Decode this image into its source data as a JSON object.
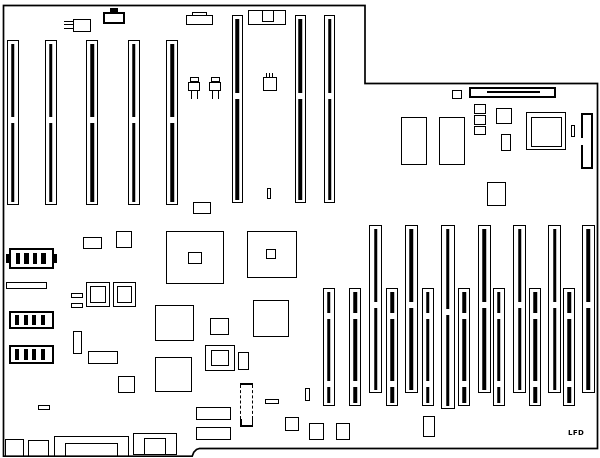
{
  "diagram": {
    "title": "motherboard-layout-diagram",
    "label": {
      "text": "LFD",
      "x": 568,
      "y": 429
    },
    "colors": {
      "line": "#000000",
      "background": "#ffffff"
    },
    "board_path": "M3.5 5.5 H365 V83.5 H597.5 V448.5 H199.5 L196.5 449.5 L193.8 452.2 L192.2 456.2 H3.5 Z",
    "primitives": [
      {
        "n": "isa-slot-1",
        "k": "s",
        "x": 6.5,
        "y": 40,
        "w": 12,
        "h": 165,
        "g": [
          0.46
        ]
      },
      {
        "n": "isa-slot-2",
        "k": "s",
        "x": 44.5,
        "y": 40,
        "w": 12,
        "h": 165,
        "g": [
          0.46
        ]
      },
      {
        "n": "isa-slot-3",
        "k": "s",
        "x": 86,
        "y": 40,
        "w": 12,
        "h": 165,
        "g": [
          0.46
        ]
      },
      {
        "n": "isa-slot-4",
        "k": "s",
        "x": 127.5,
        "y": 40,
        "w": 12,
        "h": 165,
        "g": [
          0.46
        ]
      },
      {
        "n": "isa-slot-5",
        "k": "s",
        "x": 166,
        "y": 40,
        "w": 12,
        "h": 165,
        "g": [
          0.46
        ]
      },
      {
        "n": "isa-slot-6",
        "k": "s",
        "x": 231.5,
        "y": 15,
        "w": 11,
        "h": 188,
        "g": [
          0.41
        ]
      },
      {
        "n": "isa-slot-7",
        "k": "s",
        "x": 294.5,
        "y": 15,
        "w": 11,
        "h": 188,
        "g": [
          0.41
        ]
      },
      {
        "n": "isa-slot-8",
        "k": "s",
        "x": 324,
        "y": 15,
        "w": 11,
        "h": 188,
        "g": [
          0.41
        ]
      },
      {
        "n": "mem-slot-1",
        "k": "s",
        "x": 322.5,
        "y": 288,
        "w": 12,
        "h": 118,
        "g": [
          0.2,
          0.78
        ]
      },
      {
        "n": "mem-slot-2",
        "k": "s",
        "x": 349,
        "y": 288,
        "w": 12,
        "h": 118,
        "g": [
          0.2,
          0.78
        ]
      },
      {
        "n": "mem-slot-3",
        "k": "s",
        "x": 369,
        "y": 225,
        "w": 13,
        "h": 168,
        "g": [
          0.45
        ]
      },
      {
        "n": "mem-slot-4",
        "k": "s",
        "x": 386,
        "y": 288,
        "w": 12,
        "h": 118,
        "g": [
          0.2,
          0.78
        ]
      },
      {
        "n": "mem-slot-5",
        "k": "s",
        "x": 404.5,
        "y": 225,
        "w": 13,
        "h": 168,
        "g": [
          0.45
        ]
      },
      {
        "n": "mem-slot-6",
        "k": "s",
        "x": 421.5,
        "y": 288,
        "w": 12,
        "h": 118,
        "g": [
          0.2,
          0.78
        ]
      },
      {
        "n": "mem-slot-7",
        "k": "s",
        "x": 441,
        "y": 225,
        "w": 13.5,
        "h": 184,
        "g": [
          0.45
        ]
      },
      {
        "n": "mem-slot-8",
        "k": "s",
        "x": 458,
        "y": 288,
        "w": 12,
        "h": 118,
        "g": [
          0.2,
          0.78
        ]
      },
      {
        "n": "mem-slot-9",
        "k": "s",
        "x": 477.5,
        "y": 225,
        "w": 13,
        "h": 168,
        "g": [
          0.45
        ]
      },
      {
        "n": "mem-slot-10",
        "k": "s",
        "x": 492.5,
        "y": 288,
        "w": 12,
        "h": 118,
        "g": [
          0.2,
          0.78
        ]
      },
      {
        "n": "mem-slot-11",
        "k": "s",
        "x": 513,
        "y": 225,
        "w": 13,
        "h": 168,
        "g": [
          0.45
        ]
      },
      {
        "n": "mem-slot-12",
        "k": "s",
        "x": 529,
        "y": 288,
        "w": 12,
        "h": 118,
        "g": [
          0.2,
          0.78
        ]
      },
      {
        "n": "mem-slot-13",
        "k": "s",
        "x": 548,
        "y": 225,
        "w": 13,
        "h": 168,
        "g": [
          0.45
        ]
      },
      {
        "n": "mem-slot-14",
        "k": "s",
        "x": 563,
        "y": 288,
        "w": 12,
        "h": 118,
        "g": [
          0.2,
          0.78
        ]
      },
      {
        "n": "mem-slot-15",
        "k": "s",
        "x": 581.5,
        "y": 225,
        "w": 13,
        "h": 168,
        "g": [
          0.45
        ]
      },
      {
        "n": "crystal-body",
        "k": "r",
        "x": 72.5,
        "y": 18.5,
        "w": 18.5,
        "h": 13
      },
      {
        "n": "crystal-pin-1",
        "k": "f",
        "x": 63.5,
        "y": 20.8,
        "w": 9.5,
        "h": 1.3
      },
      {
        "n": "crystal-pin-2",
        "k": "f",
        "x": 63.5,
        "y": 24.2,
        "w": 9.5,
        "h": 1.3
      },
      {
        "n": "crystal-pin-3",
        "k": "f",
        "x": 63.5,
        "y": 27.6,
        "w": 9.5,
        "h": 1.3
      },
      {
        "n": "top-connector-tab",
        "k": "f",
        "x": 110,
        "y": 8,
        "w": 7.5,
        "h": 4.5
      },
      {
        "n": "top-connector-body",
        "k": "t",
        "x": 103,
        "y": 11.5,
        "w": 22,
        "h": 12
      },
      {
        "n": "kbd-connector-step",
        "k": "r",
        "x": 191.5,
        "y": 12,
        "w": 15,
        "h": 3.5
      },
      {
        "n": "kbd-connector-body",
        "k": "r",
        "x": 186,
        "y": 15,
        "w": 26.5,
        "h": 10
      },
      {
        "n": "din-connector-body",
        "k": "r",
        "x": 248,
        "y": 10,
        "w": 38,
        "h": 15
      },
      {
        "n": "din-connector-notch",
        "k": "r",
        "x": 262,
        "y": 10,
        "w": 12,
        "h": 11.5
      },
      {
        "n": "transistor-1-tab",
        "k": "r",
        "x": 190,
        "y": 76.5,
        "w": 8.5,
        "h": 5.5
      },
      {
        "n": "transistor-1-body",
        "k": "r",
        "x": 188,
        "y": 81.5,
        "w": 12,
        "h": 9.5
      },
      {
        "n": "transistor-1-leg-1",
        "k": "f",
        "x": 191,
        "y": 91,
        "w": 1.4,
        "h": 7.5
      },
      {
        "n": "transistor-1-leg-2",
        "k": "f",
        "x": 196.5,
        "y": 91,
        "w": 1.4,
        "h": 7.5
      },
      {
        "n": "transistor-2-tab",
        "k": "r",
        "x": 211,
        "y": 76.5,
        "w": 8.5,
        "h": 5.5
      },
      {
        "n": "transistor-2-body",
        "k": "r",
        "x": 209,
        "y": 81.5,
        "w": 12,
        "h": 9.5
      },
      {
        "n": "transistor-2-leg-1",
        "k": "f",
        "x": 212,
        "y": 91,
        "w": 1.4,
        "h": 7.5
      },
      {
        "n": "transistor-2-leg-2",
        "k": "f",
        "x": 217.5,
        "y": 91,
        "w": 1.4,
        "h": 7.5
      },
      {
        "n": "cap-pin-1",
        "k": "f",
        "x": 265.5,
        "y": 72.5,
        "w": 1.3,
        "h": 5
      },
      {
        "n": "cap-pin-2",
        "k": "f",
        "x": 268.5,
        "y": 72.5,
        "w": 1.3,
        "h": 5
      },
      {
        "n": "cap-pin-3",
        "k": "f",
        "x": 271.5,
        "y": 72.5,
        "w": 1.3,
        "h": 5
      },
      {
        "n": "cap-body",
        "k": "r",
        "x": 263,
        "y": 77,
        "w": 14,
        "h": 14
      },
      {
        "n": "mid-tiny-vrect",
        "k": "r",
        "x": 267,
        "y": 188,
        "w": 4,
        "h": 10.5
      },
      {
        "n": "ne-small-rect",
        "k": "r",
        "x": 451.5,
        "y": 89.5,
        "w": 10.5,
        "h": 9
      },
      {
        "n": "ne-long-connector",
        "k": "t",
        "x": 469,
        "y": 86.5,
        "w": 87,
        "h": 11.5
      },
      {
        "n": "ne-long-connector-key",
        "k": "f",
        "x": 487,
        "y": 90.8,
        "w": 53,
        "h": 1.8
      },
      {
        "n": "ram-chip-1",
        "k": "r",
        "x": 400.5,
        "y": 116.5,
        "w": 26,
        "h": 48.5
      },
      {
        "n": "ram-chip-2",
        "k": "r",
        "x": 438.5,
        "y": 116.5,
        "w": 26,
        "h": 48.5
      },
      {
        "n": "sq-stack-1",
        "k": "r",
        "x": 474,
        "y": 104,
        "w": 11.5,
        "h": 9.5
      },
      {
        "n": "sq-stack-2",
        "k": "r",
        "x": 474,
        "y": 115,
        "w": 11.5,
        "h": 9.5
      },
      {
        "n": "sq-stack-3",
        "k": "r",
        "x": 474,
        "y": 126,
        "w": 11.5,
        "h": 8.5
      },
      {
        "n": "ne-med-square",
        "k": "r",
        "x": 496,
        "y": 107.5,
        "w": 16,
        "h": 16
      },
      {
        "n": "ne-small-vrect",
        "k": "r",
        "x": 501,
        "y": 134,
        "w": 10,
        "h": 16.5
      },
      {
        "n": "cpu-outer",
        "k": "r",
        "x": 526,
        "y": 112,
        "w": 40,
        "h": 38
      },
      {
        "n": "cpu-inner",
        "k": "r",
        "x": 530.5,
        "y": 116.5,
        "w": 31.5,
        "h": 30
      },
      {
        "n": "cpu-side-rect",
        "k": "r",
        "x": 570.5,
        "y": 124.5,
        "w": 4.5,
        "h": 12.5
      },
      {
        "n": "right-edge-connector",
        "k": "t",
        "x": 580.5,
        "y": 112.5,
        "w": 12,
        "h": 56
      },
      {
        "n": "right-edge-connector-gap",
        "k": "w",
        "x": 578.5,
        "y": 138,
        "w": 5,
        "h": 6.5
      },
      {
        "n": "ne-square-low",
        "k": "r",
        "x": 486.5,
        "y": 182,
        "w": 19.5,
        "h": 24
      },
      {
        "n": "chip-1-outer",
        "k": "r",
        "x": 166,
        "y": 231,
        "w": 58,
        "h": 53
      },
      {
        "n": "chip-1-inner",
        "k": "r",
        "x": 188,
        "y": 251.5,
        "w": 13.5,
        "h": 12
      },
      {
        "n": "chip-2-outer",
        "k": "r",
        "x": 247,
        "y": 231,
        "w": 50,
        "h": 47
      },
      {
        "n": "chip-2-inner",
        "k": "r",
        "x": 266,
        "y": 249,
        "w": 10,
        "h": 10
      },
      {
        "n": "mid-small-rect",
        "k": "r",
        "x": 193,
        "y": 201.5,
        "w": 17.5,
        "h": 12
      },
      {
        "n": "left-small-rect",
        "k": "r",
        "x": 83,
        "y": 237,
        "w": 18.5,
        "h": 12
      },
      {
        "n": "left-small-square",
        "k": "r",
        "x": 116,
        "y": 231,
        "w": 16,
        "h": 16.5
      },
      {
        "n": "battery",
        "k": "t",
        "x": 9,
        "y": 248,
        "w": 44.5,
        "h": 20.5
      },
      {
        "n": "battery-cell-1",
        "k": "f",
        "x": 15.5,
        "y": 252.5,
        "w": 4.5,
        "h": 11.5
      },
      {
        "n": "battery-cell-2",
        "k": "f",
        "x": 24,
        "y": 252.5,
        "w": 4.5,
        "h": 11.5
      },
      {
        "n": "battery-cell-3",
        "k": "f",
        "x": 32.5,
        "y": 252.5,
        "w": 4.5,
        "h": 11.5
      },
      {
        "n": "battery-cell-4",
        "k": "f",
        "x": 41,
        "y": 252.5,
        "w": 4.5,
        "h": 11.5
      },
      {
        "n": "battery-tab-left",
        "k": "f",
        "x": 5.5,
        "y": 253.5,
        "w": 3.5,
        "h": 9.5
      },
      {
        "n": "battery-tab-right",
        "k": "f",
        "x": 53.5,
        "y": 253.5,
        "w": 3.5,
        "h": 9.5
      },
      {
        "n": "jumper-block-1",
        "k": "t",
        "x": 9,
        "y": 310.5,
        "w": 44.5,
        "h": 18.5
      },
      {
        "n": "jumper-1-pin-1",
        "k": "f",
        "x": 15,
        "y": 314.5,
        "w": 4,
        "h": 10.5
      },
      {
        "n": "jumper-1-pin-2",
        "k": "f",
        "x": 23.5,
        "y": 314.5,
        "w": 4,
        "h": 10.5
      },
      {
        "n": "jumper-1-pin-3",
        "k": "f",
        "x": 32,
        "y": 314.5,
        "w": 4,
        "h": 10.5
      },
      {
        "n": "jumper-1-pin-4",
        "k": "f",
        "x": 40.5,
        "y": 314.5,
        "w": 4,
        "h": 10.5
      },
      {
        "n": "jumper-block-2",
        "k": "t",
        "x": 9,
        "y": 345,
        "w": 44.5,
        "h": 18.5
      },
      {
        "n": "jumper-2-pin-1",
        "k": "f",
        "x": 15,
        "y": 349,
        "w": 4,
        "h": 10.5
      },
      {
        "n": "jumper-2-pin-2",
        "k": "f",
        "x": 23.5,
        "y": 349,
        "w": 4,
        "h": 10.5
      },
      {
        "n": "jumper-2-pin-3",
        "k": "f",
        "x": 32,
        "y": 349,
        "w": 4,
        "h": 10.5
      },
      {
        "n": "jumper-2-pin-4",
        "k": "f",
        "x": 40.5,
        "y": 349,
        "w": 4,
        "h": 10.5
      },
      {
        "n": "left-hbar",
        "k": "r",
        "x": 6,
        "y": 281.5,
        "w": 41,
        "h": 7
      },
      {
        "n": "tiny-hbar-1",
        "k": "r",
        "x": 71,
        "y": 293,
        "w": 12,
        "h": 4.5
      },
      {
        "n": "tiny-hbar-2",
        "k": "r",
        "x": 71,
        "y": 303,
        "w": 12,
        "h": 4.5
      },
      {
        "n": "dbl-square-1-outer",
        "k": "r",
        "x": 86,
        "y": 281.5,
        "w": 24,
        "h": 25
      },
      {
        "n": "dbl-square-1-inner",
        "k": "r",
        "x": 90,
        "y": 286,
        "w": 16,
        "h": 17
      },
      {
        "n": "dbl-square-2-outer",
        "k": "r",
        "x": 112.5,
        "y": 281.5,
        "w": 23.5,
        "h": 25
      },
      {
        "n": "dbl-square-2-inner",
        "k": "r",
        "x": 116.5,
        "y": 286,
        "w": 15.5,
        "h": 17
      },
      {
        "n": "left-vrect",
        "k": "r",
        "x": 72.5,
        "y": 330.5,
        "w": 9,
        "h": 23
      },
      {
        "n": "left-hrect",
        "k": "r",
        "x": 88,
        "y": 350.5,
        "w": 29.5,
        "h": 13.5
      },
      {
        "n": "left-square-low",
        "k": "r",
        "x": 118,
        "y": 375.5,
        "w": 16.5,
        "h": 17
      },
      {
        "n": "big-square-1",
        "k": "r",
        "x": 155,
        "y": 305,
        "w": 38.5,
        "h": 35.5
      },
      {
        "n": "big-square-2",
        "k": "r",
        "x": 155,
        "y": 356.5,
        "w": 37,
        "h": 35
      },
      {
        "n": "mid-square-1",
        "k": "r",
        "x": 210,
        "y": 317.5,
        "w": 19,
        "h": 17.5
      },
      {
        "n": "mid-square-2",
        "k": "r",
        "x": 252.5,
        "y": 300,
        "w": 36.5,
        "h": 37
      },
      {
        "n": "dbl-square-3-outer",
        "k": "r",
        "x": 205,
        "y": 345,
        "w": 29.5,
        "h": 25.5
      },
      {
        "n": "dbl-square-3-inner",
        "k": "r",
        "x": 211,
        "y": 350,
        "w": 18,
        "h": 16
      },
      {
        "n": "mid-vrect",
        "k": "r",
        "x": 237.5,
        "y": 351.5,
        "w": 11,
        "h": 18.5
      },
      {
        "n": "tiny-hbar-3",
        "k": "r",
        "x": 37.5,
        "y": 405,
        "w": 12,
        "h": 5
      },
      {
        "n": "bm-rect-1",
        "k": "r",
        "x": 196,
        "y": 407,
        "w": 34.5,
        "h": 12.5
      },
      {
        "n": "bm-rect-2",
        "k": "r",
        "x": 196,
        "y": 427,
        "w": 34.5,
        "h": 12.5
      },
      {
        "n": "dash-comp-top",
        "k": "f",
        "x": 240,
        "y": 383,
        "w": 13,
        "h": 1.5
      },
      {
        "n": "dash-comp-left",
        "k": "d",
        "x": 240.2,
        "y": 385,
        "w": 0,
        "h": 34
      },
      {
        "n": "dash-comp-right",
        "k": "d",
        "x": 251.6,
        "y": 385,
        "w": 0,
        "h": 34
      },
      {
        "n": "dash-comp-bot-l",
        "k": "f",
        "x": 240,
        "y": 419,
        "w": 1.5,
        "h": 7.5
      },
      {
        "n": "dash-comp-bot-r",
        "k": "f",
        "x": 251.5,
        "y": 419,
        "w": 1.5,
        "h": 7.5
      },
      {
        "n": "dash-comp-bot",
        "k": "f",
        "x": 240,
        "y": 425,
        "w": 13,
        "h": 1.5
      },
      {
        "n": "bm-hbar",
        "k": "r",
        "x": 265,
        "y": 399,
        "w": 13.5,
        "h": 4.5
      },
      {
        "n": "bm-square-1",
        "k": "r",
        "x": 285,
        "y": 417,
        "w": 13.5,
        "h": 14
      },
      {
        "n": "bm-square-2",
        "k": "r",
        "x": 309,
        "y": 423,
        "w": 15,
        "h": 16.5
      },
      {
        "n": "bm-square-3",
        "k": "r",
        "x": 336,
        "y": 422.5,
        "w": 14,
        "h": 17
      },
      {
        "n": "bm-tiny-vrect",
        "k": "r",
        "x": 305,
        "y": 388,
        "w": 4.5,
        "h": 13
      },
      {
        "n": "br-vrect",
        "k": "r",
        "x": 422.5,
        "y": 416,
        "w": 12,
        "h": 20.5
      },
      {
        "n": "bl-rect-1",
        "k": "r",
        "x": 4.5,
        "y": 439,
        "w": 19.5,
        "h": 17.5
      },
      {
        "n": "bl-rect-2",
        "k": "r",
        "x": 28,
        "y": 440,
        "w": 20.5,
        "h": 16.5
      },
      {
        "n": "bottom-connector-outer",
        "k": "r",
        "x": 54,
        "y": 436,
        "w": 74.5,
        "h": 20.5
      },
      {
        "n": "bottom-connector-inner",
        "k": "r",
        "x": 65,
        "y": 442.5,
        "w": 52.5,
        "h": 14
      },
      {
        "n": "bottom-power-outer",
        "k": "r",
        "x": 132.5,
        "y": 433,
        "w": 44.5,
        "h": 22
      },
      {
        "n": "bottom-power-inner",
        "k": "r",
        "x": 144,
        "y": 437.5,
        "w": 21.5,
        "h": 17.5
      }
    ]
  }
}
